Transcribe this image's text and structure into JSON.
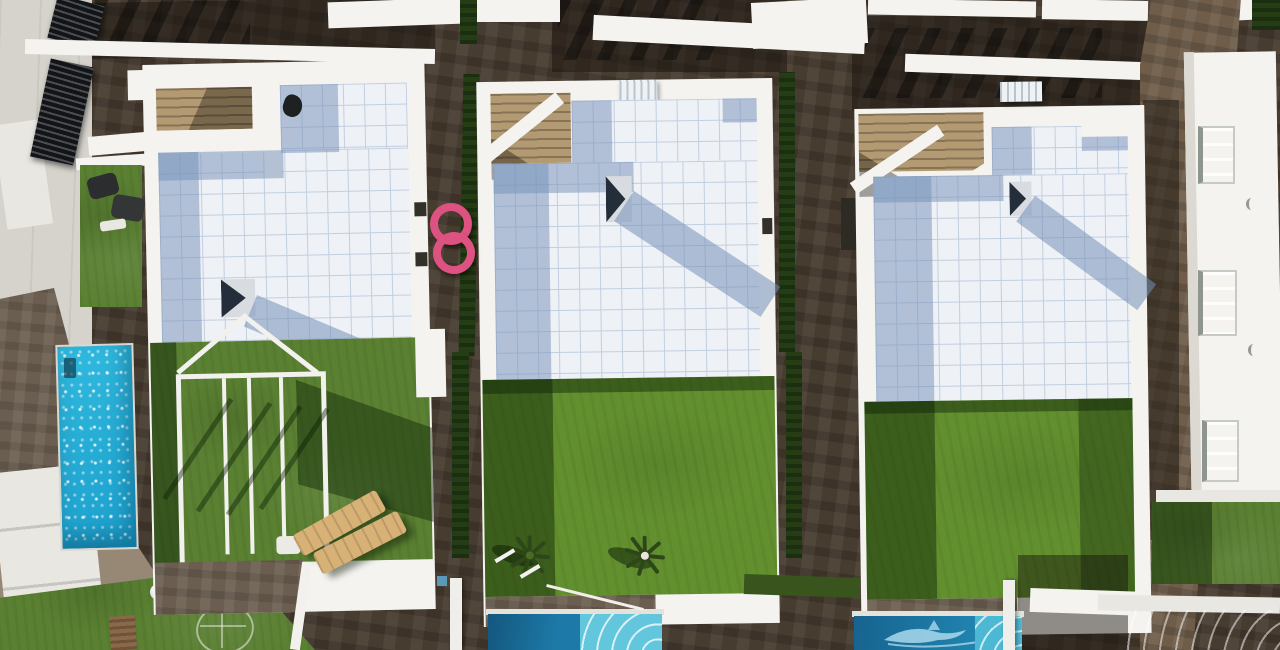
{
  "meta": {
    "title": "Aerial drone photograph, top-down view of a row of modern white villas with tiled roof terraces, artificial turf gardens and private swimming pools"
  },
  "palette": {
    "paving-dark": "#473c30",
    "paving-mid": "#6b5e50",
    "paving-warm": "#6f5d49",
    "concrete": "#d6d3cc",
    "concrete-bright": "#e9e7e2",
    "wall-white": "#f4f3ef",
    "wall-shade": "#dcd9d3",
    "tile-base": "#eef1f6",
    "tile-grid": "#c2cfe0",
    "tile-shadow": "rgba(116,143,184,0.5)",
    "stair-tan": "#b49a72",
    "grass": "#5a8032",
    "grass-bright": "#63902f",
    "grass-dark": "#39541d",
    "hedge": "#253d15",
    "pool-cyan": "#30b9de",
    "pool-cyan-deep": "#1ba0cc",
    "pool-blue": "#1d7aa8",
    "pool-blue-deep": "#13577e",
    "pool-steps": "#62c6dc",
    "float-pink": "#dd5280",
    "lounger": "#d8b177",
    "window-glass": "#b9c9d2",
    "lamp": "#f0efe9"
  },
  "scene": {
    "villas": [
      {
        "name": "villa-left",
        "features": [
          "white-tiled-roof-terrace",
          "rooftop-staircase",
          "roof-vent",
          "pyramid-skylight",
          "garden-lawn",
          "white-pergola-frame",
          "two-sun-loungers",
          "side-table"
        ]
      },
      {
        "name": "villa-middle",
        "features": [
          "white-tiled-roof-terrace",
          "rooftop-staircase",
          "air-conditioning-unit",
          "pyramid-skylight",
          "garden-lawn",
          "palm-plants",
          "pool-with-roman-steps"
        ]
      },
      {
        "name": "villa-right",
        "features": [
          "white-tiled-roof-terrace",
          "rooftop-staircase",
          "air-conditioning-unit",
          "pyramid-skylight",
          "garden-lawn",
          "pool-with-dolphin-mosaic"
        ]
      }
    ],
    "left-street": [
      "concrete-sidewalk",
      "slatted-privacy-fences",
      "narrow-lap-pool",
      "lawn-with-chairs",
      "globe-street-lamp",
      "doormat",
      "rotary-dryer"
    ],
    "right-side": [
      "neighbour-house-facade",
      "recessed-windows",
      "lawn-patch",
      "corner-pool"
    ],
    "top-row": [
      "neighbouring-villa-roofs",
      "shaded-courtyards",
      "hedge-strips"
    ],
    "loose-objects": [
      "pink-swim-rings",
      "tan-sun-loungers"
    ]
  }
}
